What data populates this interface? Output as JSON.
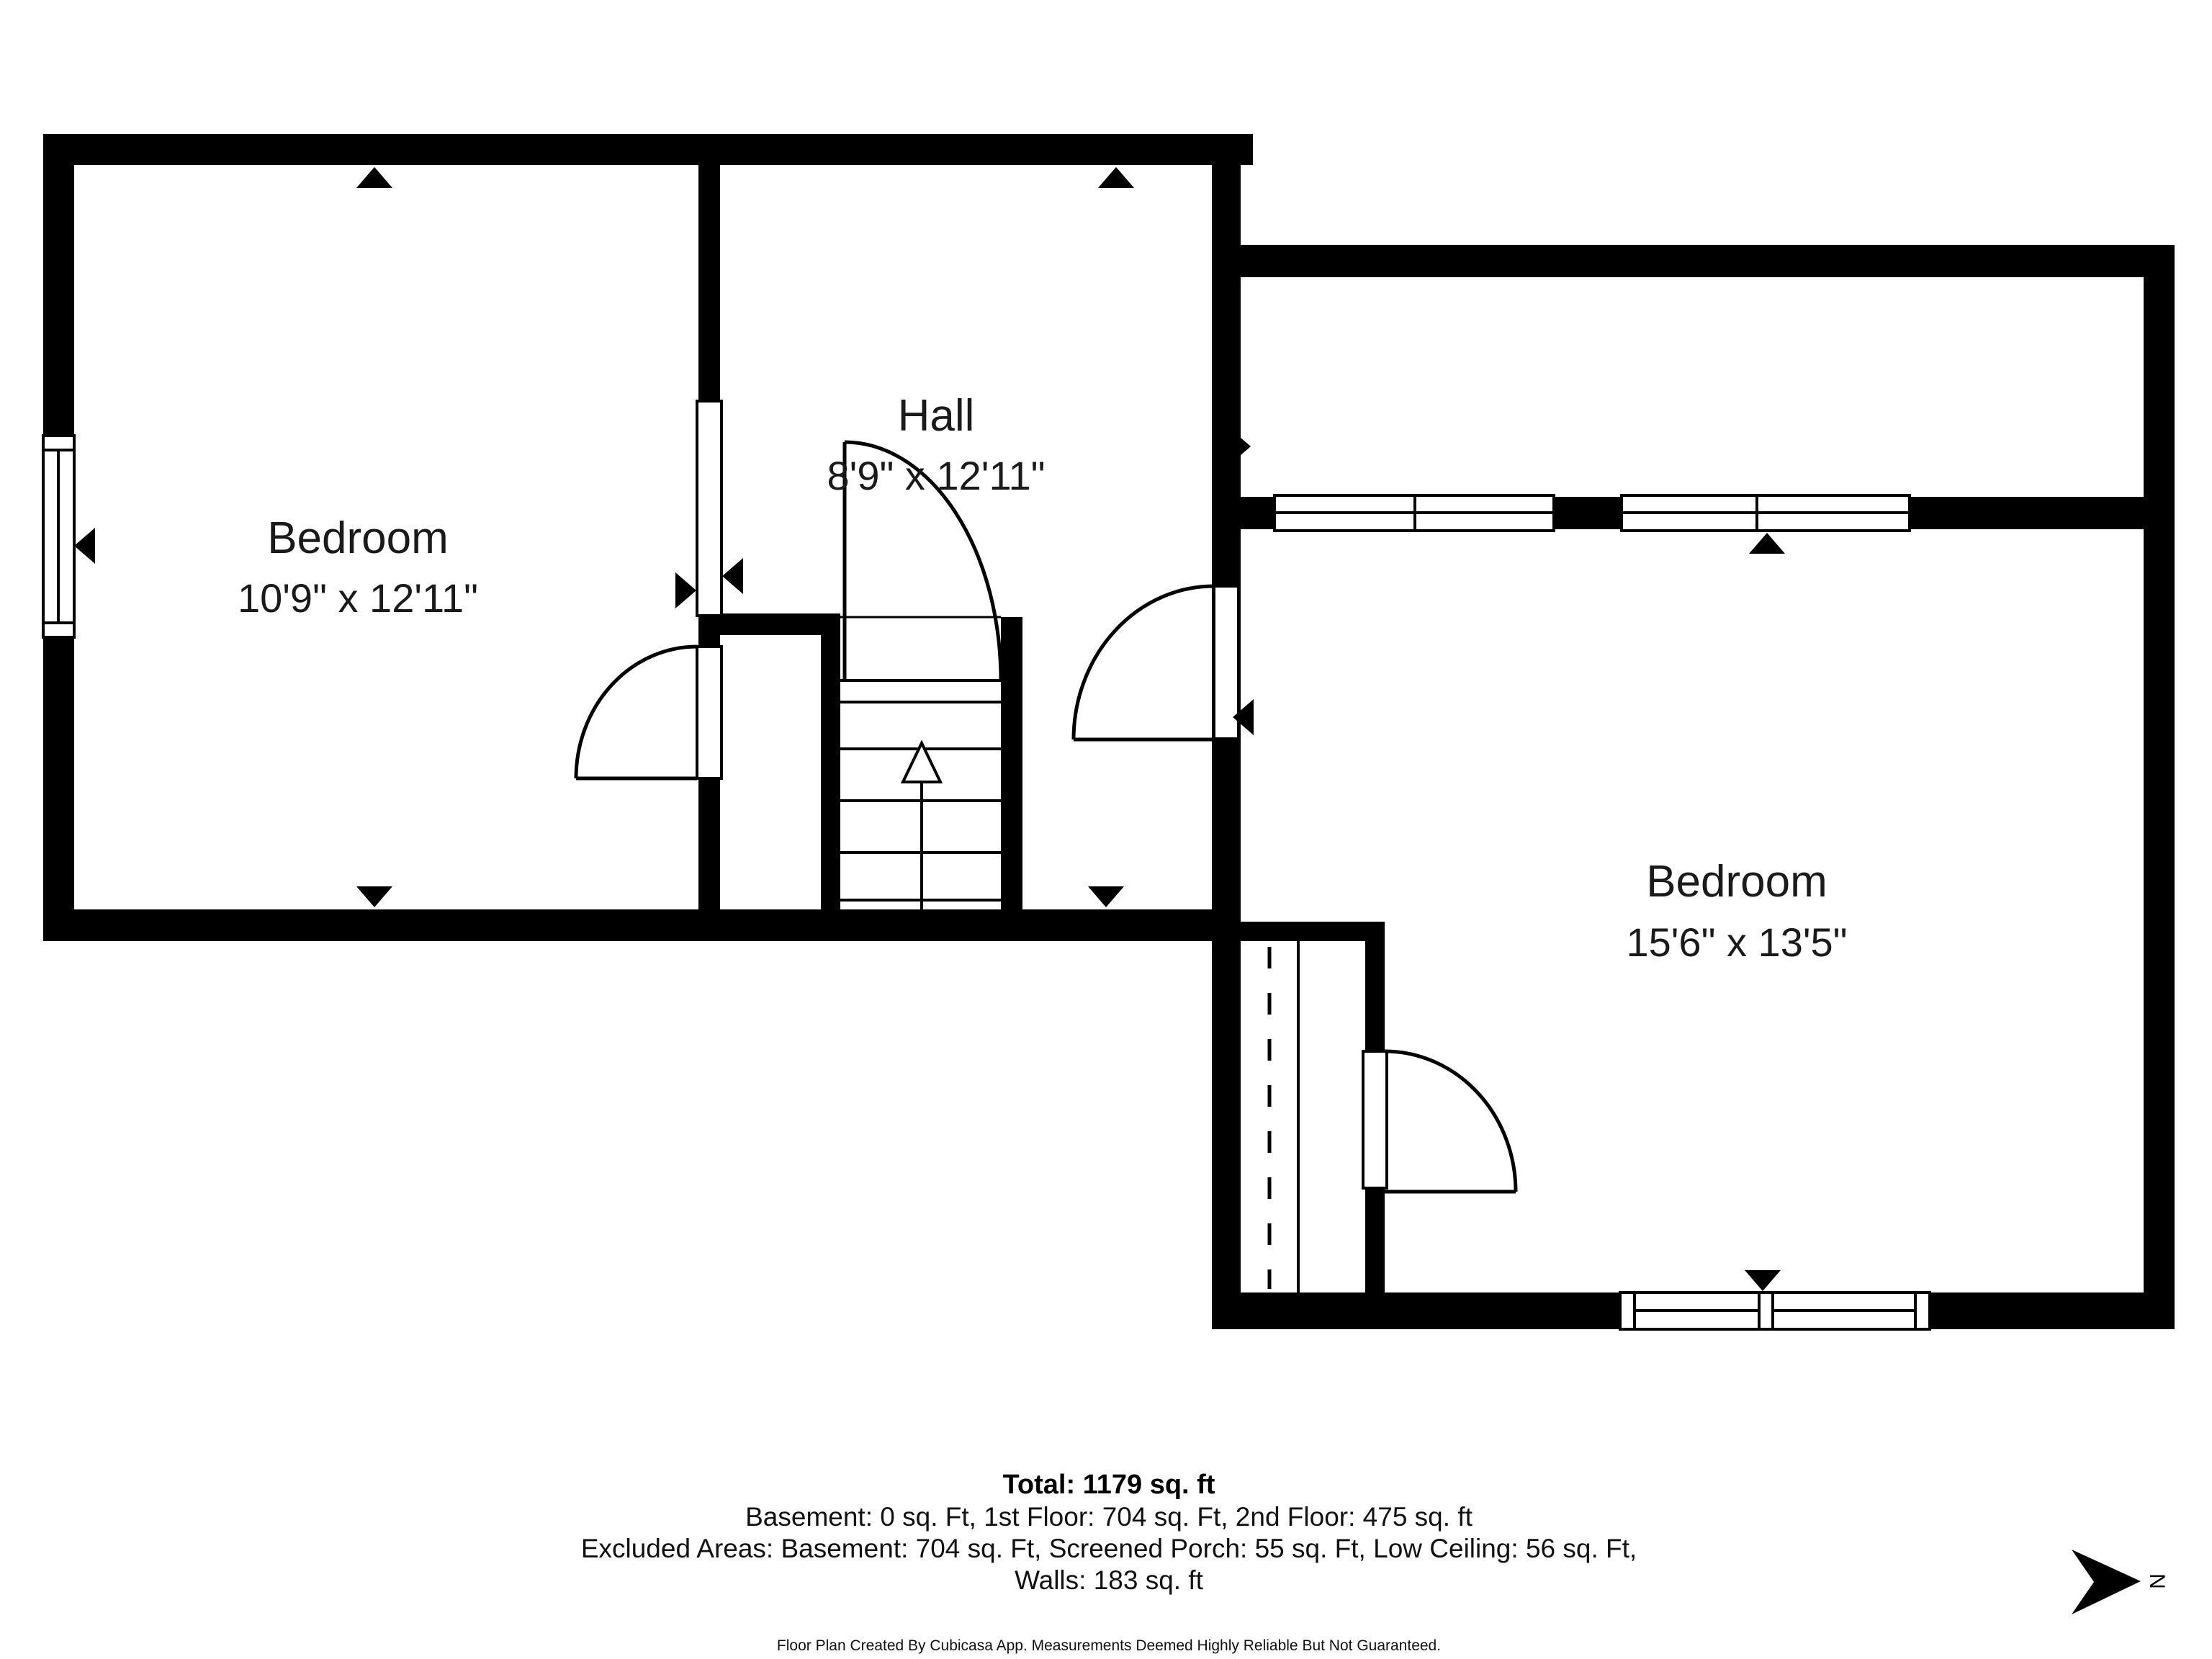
{
  "title": "Second floor plan",
  "colors": {
    "wall": "#000000",
    "background": "#ffffff",
    "text": "#1a1a1a"
  },
  "rooms": [
    {
      "id": "bedroom-left",
      "name": "Bedroom",
      "dims": "10'9\" x 12'11\""
    },
    {
      "id": "hall",
      "name": "Hall",
      "dims": "8'9\" x 12'11\""
    },
    {
      "id": "bedroom-right",
      "name": "Bedroom",
      "dims": "15'6\" x 13'5\""
    }
  ],
  "footer": {
    "total": "Total: 1179 sq. ft",
    "floors": "Basement: 0 sq. Ft, 1st Floor: 704 sq. Ft, 2nd Floor: 475 sq. ft",
    "excluded": "Excluded Areas: Basement: 704 sq. Ft, Screened Porch: 55 sq. Ft, Low Ceiling: 56 sq. Ft,",
    "walls": "Walls: 183 sq. ft",
    "disclaimer": "Floor Plan Created By Cubicasa App. Measurements Deemed Highly Reliable But Not Guaranteed."
  },
  "compass": {
    "label": "N"
  },
  "features": {
    "stairs": "stairs-up",
    "doors": [
      "hall-stair-door",
      "hall-to-bedroom-door",
      "bedroom-left-closet-door",
      "low-ceiling-closet-door"
    ],
    "windows": [
      "bedroom-left-window",
      "hall-pass-through",
      "porch-window-1",
      "porch-window-2",
      "bedroom-right-window"
    ]
  }
}
